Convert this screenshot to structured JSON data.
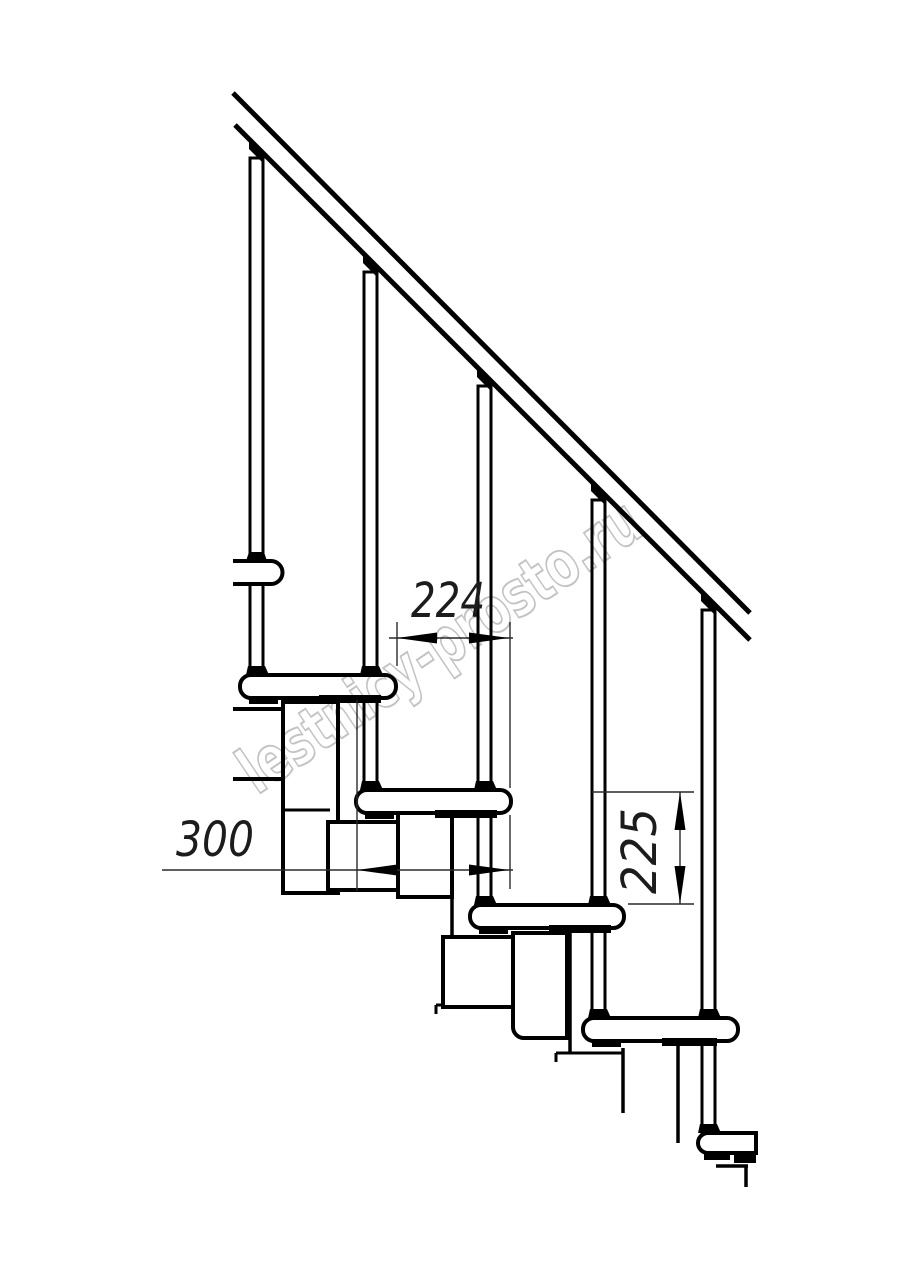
{
  "title": "Modular staircase side-view technical drawing",
  "watermark": {
    "text": "lestnicy-prosto.ru",
    "color": "#b4b4b4"
  },
  "dimensions": {
    "going_mm": "224",
    "tread_depth_mm": "300",
    "rise_mm": "225"
  },
  "style": {
    "line_color": "#000000",
    "background": "#ffffff",
    "dim_line_color": "#2a2a2a"
  }
}
